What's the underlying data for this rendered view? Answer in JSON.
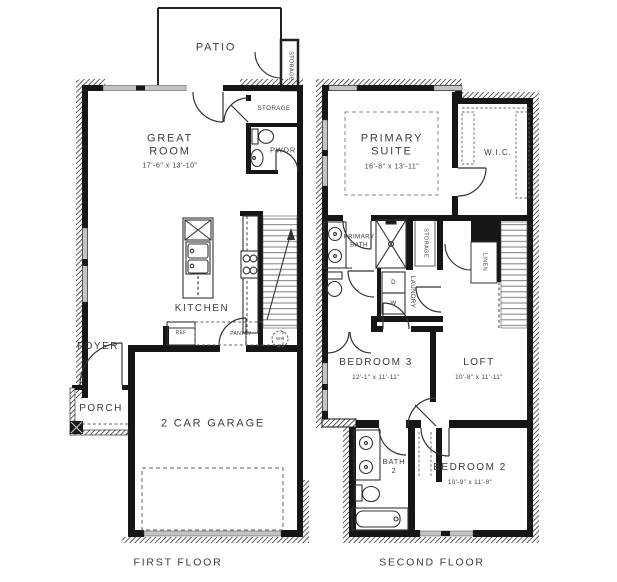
{
  "colors": {
    "wall": "#161616",
    "label": "#3c3c3c",
    "window_band": "#c4c4c4",
    "line": "#2e2e2e",
    "background": "#ffffff"
  },
  "first_floor": {
    "caption": "FIRST FLOOR",
    "rooms": {
      "patio": {
        "label": "PATIO"
      },
      "patio_storage": {
        "label": "STORAGE"
      },
      "storage": {
        "label": "STORAGE"
      },
      "powder": {
        "label": "PWDR"
      },
      "great_room": {
        "label": "GREAT ROOM",
        "dims": "17'-6\" x 13'-10\""
      },
      "kitchen": {
        "label": "KITCHEN"
      },
      "foyer": {
        "label": "FOYER"
      },
      "porch": {
        "label": "PORCH"
      },
      "garage": {
        "label": "2 CAR GARAGE"
      }
    },
    "fixtures": {
      "refrigerator": "REF",
      "pantry": "PANTRY",
      "water_heater": "WH"
    }
  },
  "second_floor": {
    "caption": "SECOND FLOOR",
    "rooms": {
      "primary_suite": {
        "label": "PRIMARY SUITE",
        "dims": "16'-8\" x 13'-11\""
      },
      "walk_in_closet": {
        "label": "W.I.C."
      },
      "primary_bath": {
        "label": "PRIMARY BATH"
      },
      "storage": {
        "label": "STORAGE"
      },
      "laundry": {
        "label": "LAUNDRY"
      },
      "linen": {
        "label": "LINEN"
      },
      "bedroom3": {
        "label": "BEDROOM 3",
        "dims": "12'-1\" x 11'-11\""
      },
      "loft": {
        "label": "LOFT",
        "dims": "10'-8\" x 11'-11\""
      },
      "bath2": {
        "label": "BATH 2"
      },
      "bedroom2": {
        "label": "BEDROOM 2",
        "dims": "10'-9\" x 11'-8\""
      }
    },
    "fixtures": {
      "dryer": "D",
      "washer": "W"
    }
  }
}
